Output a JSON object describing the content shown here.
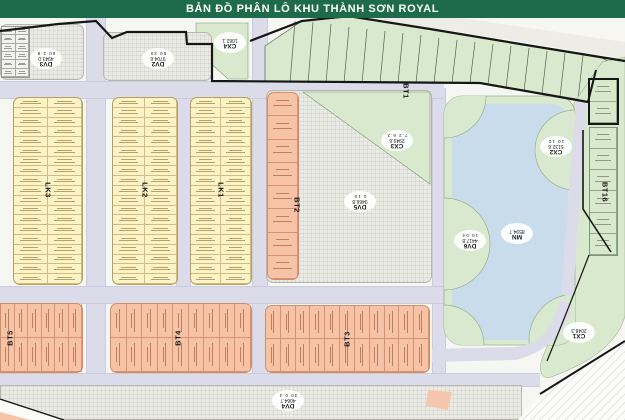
{
  "header": {
    "title": "BẢN ĐỒ PHÂN LÔ KHU THÀNH SƠN ROYAL"
  },
  "colors": {
    "header": "#1D6B4B",
    "road": "#DCDBEA",
    "yellow_block": "#FDF3C6",
    "salmon_block": "#F7C3A7",
    "green_block": "#D9E9CD",
    "lake": "#C8DCEC",
    "boundary": "#161616"
  },
  "strips": {
    "lk1": "LK1",
    "lk2": "LK2",
    "lk3": "LK3",
    "bt1": "BT1",
    "bt2": "BT2",
    "bt3": "BT3",
    "bt4": "BT4",
    "bt5": "BT5",
    "bt16": "BT16"
  },
  "badges": {
    "dv3": {
      "name": "DV3",
      "area": "4943.0",
      "dims": "50 3.8"
    },
    "dv2": {
      "name": "DV2",
      "area": "9704.6",
      "dims": "50 30"
    },
    "cx4": {
      "name": "CX4",
      "area": "1062.1",
      "dims": ""
    },
    "cx3": {
      "name": "CX3",
      "area": "2949.6",
      "dims": "7.2 6.2"
    },
    "dv5": {
      "name": "DV5",
      "area": "9466.8",
      "dims": "2 10"
    },
    "dv6": {
      "name": "DV6",
      "area": "4417.8",
      "dims": "10 04"
    },
    "cx2": {
      "name": "CX2",
      "area": "5132.6",
      "dims": "10 10"
    },
    "mn": {
      "name": "MN",
      "area": "8594.7",
      "dims": ""
    },
    "cx1": {
      "name": "CX1",
      "area": "2048.3",
      "dims": ""
    },
    "dv4": {
      "name": "DV4",
      "area": "4064.7",
      "dims": "30 0.4"
    }
  },
  "lots": {
    "lk3": {
      "cols": 2,
      "rows": 19
    },
    "lk2": {
      "cols": 2,
      "rows": 19
    },
    "lk1": {
      "cols": 2,
      "rows": 19
    },
    "bt2": {
      "cols": 1,
      "rows": 8
    },
    "bt5": {
      "cols": 6,
      "rows": 2
    },
    "bt4": {
      "cols": 9,
      "rows": 2
    },
    "bt3": {
      "cols": 11,
      "rows": 2
    },
    "bt16a": {
      "cols": 1,
      "rows": 2
    },
    "bt16b": {
      "cols": 1,
      "rows": 6
    },
    "dv3lots": {
      "cols": 2,
      "rows": 6
    }
  }
}
